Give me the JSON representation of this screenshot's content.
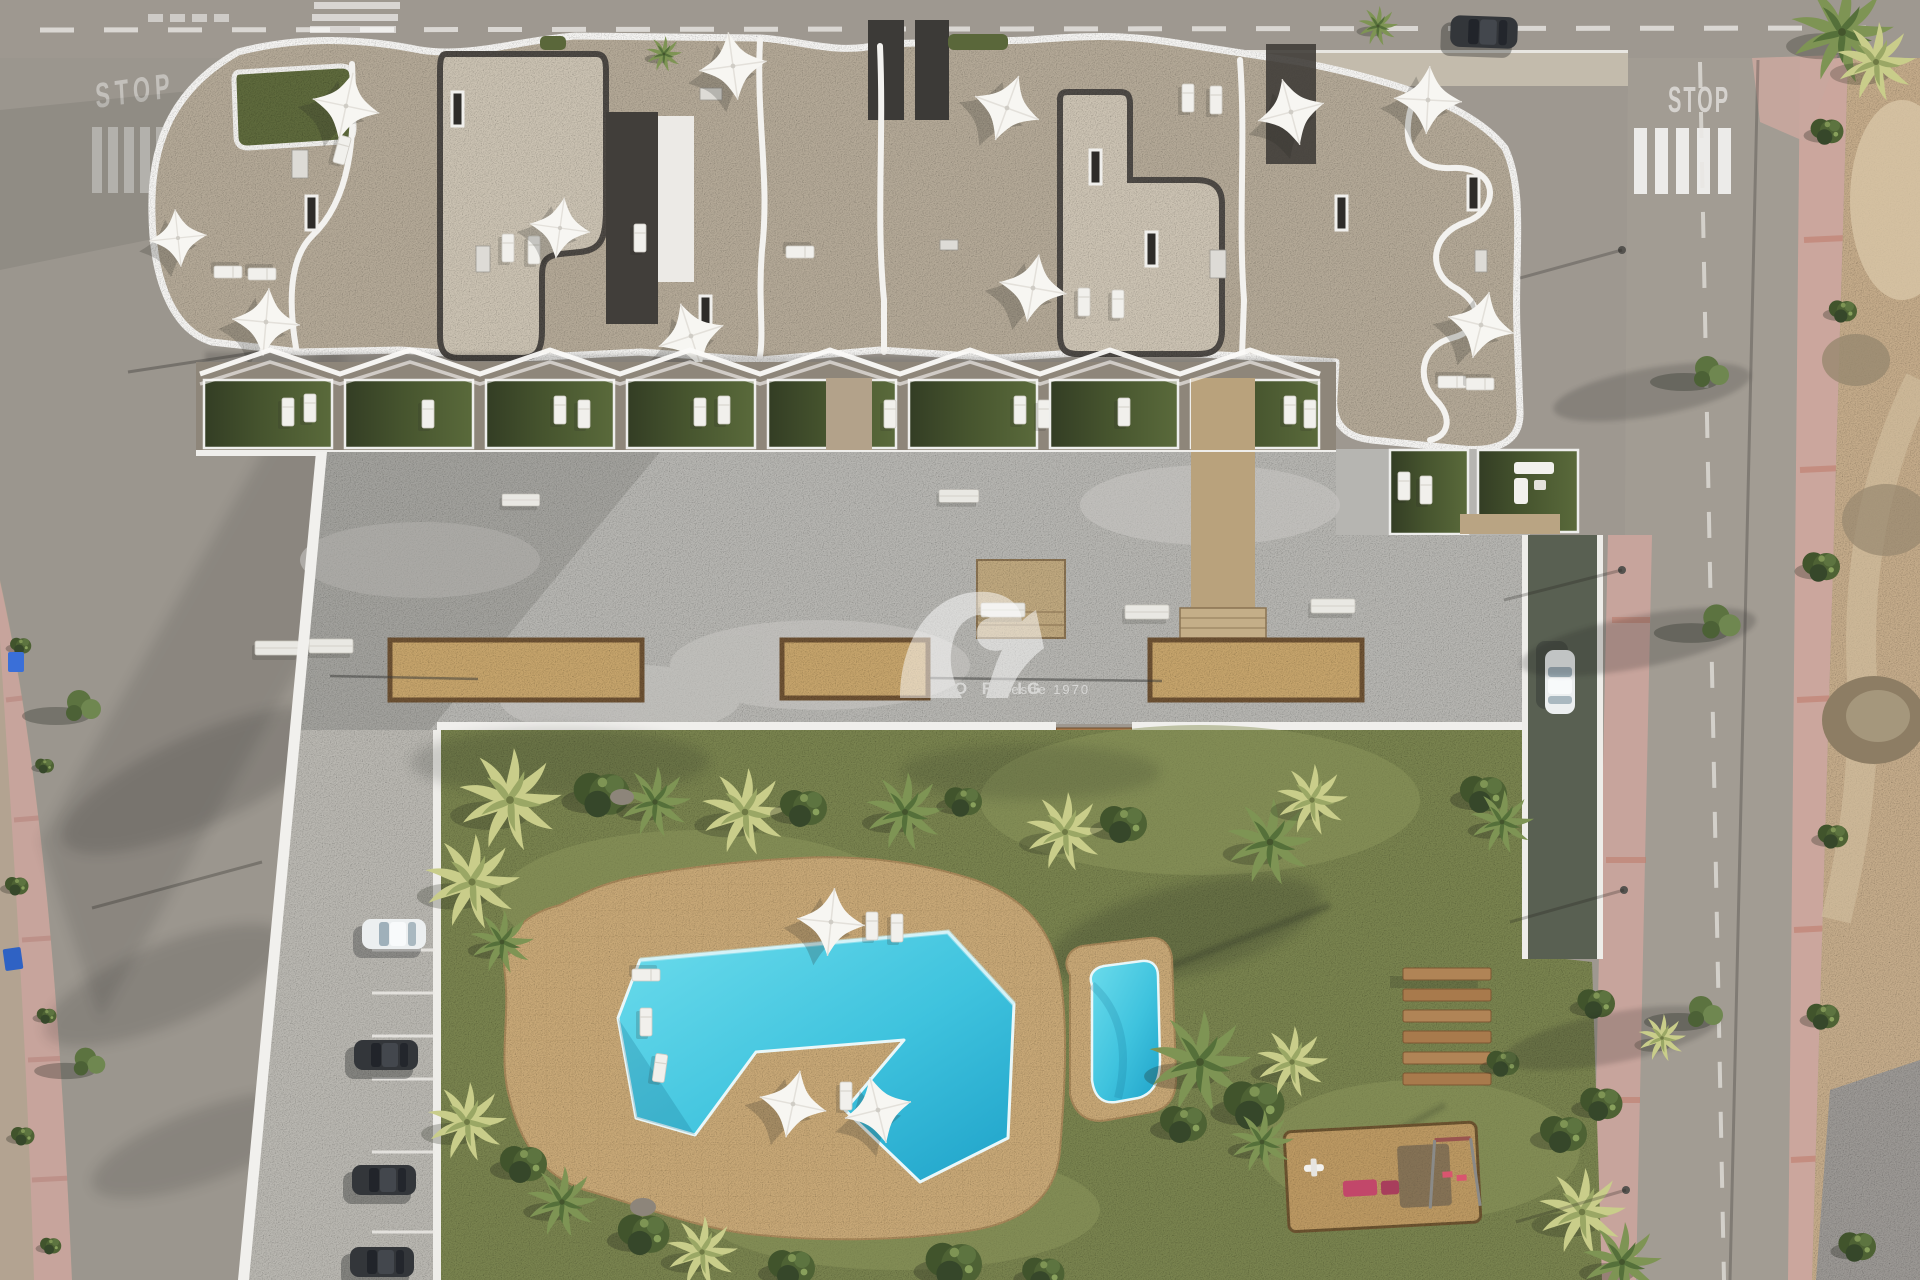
{
  "meta": {
    "title": "Aerial 3D render of residential complex",
    "type": "top-down architectural visualization"
  },
  "watermark": {
    "brand": "CABO ROIG",
    "tagline": "Desde 1970",
    "color": "#ffffff",
    "logo": "sv-swoosh-logo"
  },
  "road_markings": {
    "stop_left": "STOP",
    "stop_right": "STOP"
  },
  "palette": {
    "grass": "#798350",
    "pool_water": "#3fc3de",
    "pool_deck": "#c8a877",
    "roof_tile": "#b4a997",
    "roof_gravel": "#cbc2b2",
    "roof_dark": "#413e3a",
    "parapet_white": "#f5f4f2",
    "plaza_concrete": "#b6b5b1",
    "road_asphalt": "#9e9890",
    "sidewalk_pink": "#c7a49c",
    "vacant_lot": "#c4ab8a",
    "planter_sand": "#c6a46c",
    "wood": "#a87a4c",
    "terrace_lawn": "#4a5a31",
    "playground_pink": "#c2476a",
    "palm_yellow": "#c9cd8a",
    "palm_green": "#7e9454"
  },
  "scene": {
    "building": {
      "label": "apartment block with sculpted white parapets",
      "features": [
        "rooftop terraces",
        "white parasols",
        "sun loungers",
        "gravel roof slabs",
        "green roof patch"
      ]
    },
    "ground_floor": {
      "label": "private terrace gardens",
      "features": [
        "lawn plots",
        "sun loungers",
        "zigzag pergola canopy"
      ]
    },
    "plaza": {
      "label": "communal concrete deck",
      "features": [
        "sand planters",
        "white benches",
        "stone paths",
        "wooden steps"
      ]
    },
    "garden": {
      "label": "communal garden",
      "features": [
        "free-form swimming pool",
        "kids pool",
        "sun deck",
        "palm trees",
        "wooden bench row",
        "playground",
        "lawn"
      ]
    },
    "streets": {
      "top": "street with dashed center line and crossings",
      "left": "side street with pink sidewalk and dirt verge",
      "right": "avenue with zebra crossing, STOP marking and street trees",
      "far_right": "undeveloped rocky plot"
    },
    "vehicles": [
      "white parked car",
      "two dark parked cars",
      "black car on top road",
      "white car on driveway ramp"
    ]
  }
}
